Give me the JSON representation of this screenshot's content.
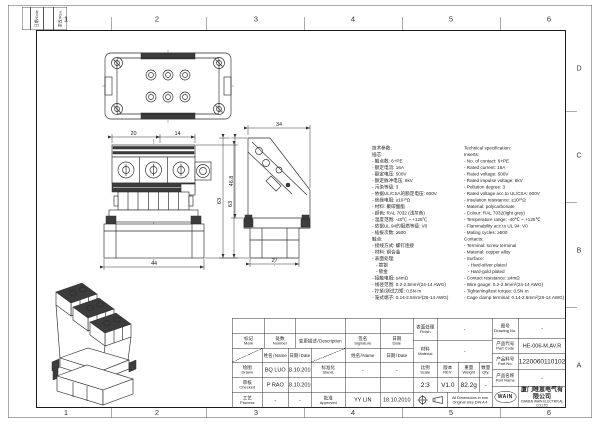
{
  "frame": {
    "column_labels": [
      "1",
      "2",
      "3",
      "4",
      "5",
      "6"
    ],
    "row_labels": [
      "D",
      "C",
      "B",
      "A"
    ],
    "corner": {
      "c1": "日期/Date",
      "c2": "更改/Rev."
    }
  },
  "views": {
    "front": {
      "dim_w1": "20",
      "dim_w2": "14",
      "dim_h": "63",
      "dim_base": "44"
    },
    "side": {
      "dim_top": "34",
      "dim_h1": "46.8",
      "dim_h2": "63",
      "dim_base": "27"
    }
  },
  "spec": {
    "cn": [
      "技术参数:",
      "插芯:",
      "- 触点数: 6+PE",
      "- 额定电流: 16A",
      "- 额定电压: 500V",
      "- 额定脉冲电压: 6kV",
      "- 污染等级: 3",
      "- 依据UL/CSA的额定电压: 600V",
      "- 绝缘电阻: ≥10¹⁰Ω",
      "- 材料: 聚碳酸酯",
      "- 颜色: RAL 7032 (浅灰色)",
      "- 温度范围: -40℃ ~ +125℃",
      "- 依据UL 94的阻燃等级: V0",
      "- 插拔次数: ≥500",
      "触点:",
      "- 接线方式: 螺钉连接",
      "- 材料: 铜合金",
      "- 表面处理:",
      "   - 镀银",
      "   - 镀金",
      "- 接触电阻: ≤4mΩ",
      "- 线径范围: 0.2-2.5mm²(24-14 AWG)",
      "- 拧紧/测试力矩: 0.5N·m",
      "- 笼式端子: 0.14-2.5mm²(26-14 AWG)"
    ],
    "en": [
      "Technical specification:",
      "Inserts:",
      "- No. of contact: 6+PE",
      "- Rated current: 16A",
      "- Rated voltage: 500V",
      "- Rated impulse voltage: 6kV",
      "- Pollution degree: 3",
      "- Rated voltage acc.to UL/CSA: 600V",
      "- Insulation resistance: ≥10¹⁰Ω",
      "- Material: polycarbonate",
      "- Colour: RAL 7032(light grey)",
      "- Temperature range: -40℃ ~ +125℃",
      "- Flammability acc.to UL 94: V0",
      "- Mating cycles: ≥500",
      "Contacts:",
      "- Terminal: screw terminal",
      "- Material: copper alloy",
      "- Surface:",
      "   - Hard-silver plated",
      "   - Hard-gold plated",
      "- Contact resistance: ≤4mΩ",
      "- Wire gauge: 0.2-2.5mm²(24-14 AWG)",
      "- Tightening/test torque: 0.5N·m",
      "- Cage clamp terminal: 0.14-2.5mm²(26-14 AWG)"
    ]
  },
  "titleblock": {
    "labels": {
      "mark_cn": "标记",
      "mark_en": "Mark",
      "number_cn": "处数",
      "number_en": "Number",
      "desc_cn": "变更描述",
      "desc_en": "Description",
      "sig_cn": "签名",
      "sig_en": "Signature",
      "date_cn": "日期",
      "date_en": "Date",
      "name_cn": "姓名",
      "name_en": "Name",
      "drawn_cn": "绘图",
      "drawn_en": "Drawn",
      "checked_cn": "审核",
      "checked_en": "Checked",
      "process_cn": "工艺",
      "process_en": "Process",
      "stand_cn": "标准化",
      "stand_en": "Stand.",
      "approved_cn": "批准",
      "approved_en": "Approved",
      "finish_cn": "表面处理",
      "finish_en": "Finish",
      "material_cn": "材料",
      "material_en": "Material",
      "scale_cn": "比例",
      "scale_en": "Scale",
      "rev_cn": "版本",
      "rev_en": "REV.",
      "weight_cn": "重量",
      "weight_en": "Weight",
      "qty_cn": "数量",
      "qty_en": "Qty.",
      "drawing_no_cn": "图号",
      "drawing_no_en": "Drawing No.",
      "part_code_cn": "产品代号",
      "part_code_en": "Part Code",
      "part_no_cn": "产品料号",
      "part_no_en": "Part No.",
      "part_name_cn": "产品名称",
      "part_name_en": "Part Name"
    },
    "values": {
      "drawn_name": "BQ LUO",
      "drawn_date": "18.10.2010",
      "stand_name": "-",
      "stand_date": "-",
      "checked_name": "P RAO",
      "checked_date": "18.10.2010",
      "process_name": "-",
      "process_date": "-",
      "approved_name": "YY LIN",
      "approved_date": "18.10.2010",
      "finish": "-",
      "material": "-",
      "scale": "2:3",
      "rev": "V1.0",
      "weight": "82.2g",
      "qty": "-",
      "drawing_no": "-",
      "part_code": "HE-006-M.AV.R",
      "part_no": "1220060110102",
      "part_name": "-"
    },
    "note_line1": "All Dimensions in mm",
    "note_line2": "Original Size DIN A 4",
    "company": {
      "logo": "WAIN",
      "cn": "厦门唯恩电气有限公司",
      "en": "XIAMEN WAIN ELECTRICAL CO.LTD"
    }
  }
}
